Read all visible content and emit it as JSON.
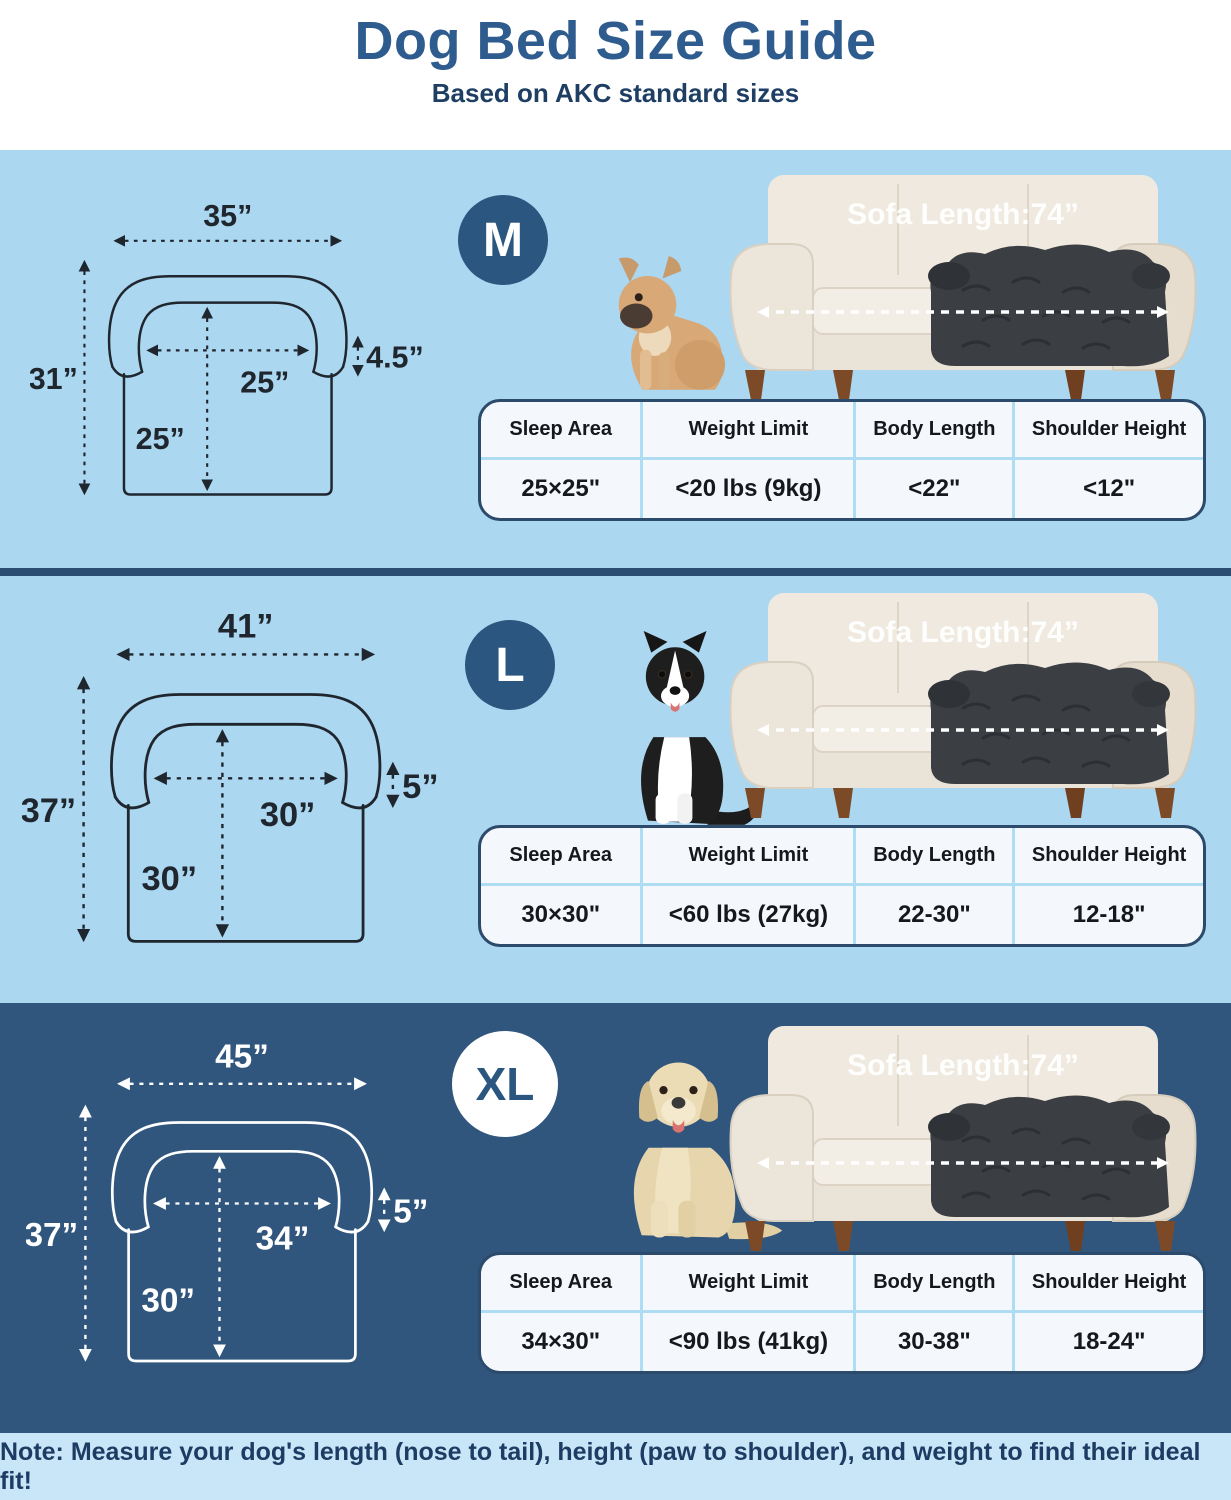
{
  "header": {
    "title": "Dog Bed Size Guide",
    "subtitle": "Based on AKC standard sizes"
  },
  "table_headers": [
    "Sleep Area",
    "Weight Limit",
    "Body Length",
    "Shoulder Height"
  ],
  "sofa_label": "Sofa Length:74”",
  "sections": [
    {
      "size": "M",
      "dog": "french-bulldog",
      "dims": {
        "width": "35”",
        "height": "31”",
        "inner_width": "25”",
        "inner_depth": "25”",
        "bolster": "4.5”"
      },
      "table": [
        "25×25\"",
        "<20 lbs (9kg)",
        "<22\"",
        "<12\""
      ]
    },
    {
      "size": "L",
      "dog": "border-collie",
      "dims": {
        "width": "41”",
        "height": "37”",
        "inner_width": "30”",
        "inner_depth": "30”",
        "bolster": "5”"
      },
      "table": [
        "30×30\"",
        "<60 lbs (27kg)",
        "22-30\"",
        "12-18\""
      ]
    },
    {
      "size": "XL",
      "dog": "labrador-retriever",
      "dims": {
        "width": "45”",
        "height": "37”",
        "inner_width": "34”",
        "inner_depth": "30”",
        "bolster": "5”"
      },
      "table": [
        "34×30\"",
        "<90 lbs (41kg)",
        "30-38\"",
        "18-24\""
      ]
    }
  ],
  "note": {
    "text": "Note: Measure your dog's length (nose to tail), height (paw to shoulder), and weight to find their ideal fit!"
  },
  "colors": {
    "title_blue": "#2e5c8e",
    "subtitle_navy": "#1e3f63",
    "section_light_blue": "#abd7f1",
    "section_dark_blue": "#31567d",
    "divider_navy": "#2c4d72",
    "badge_blue": "#2a567f",
    "table_bg": "#f4f8fc",
    "table_border": "#2c4a6b",
    "table_divider": "#aedcf2",
    "note_bg": "#c8e6f8",
    "diagram_line_dark": "#20262e",
    "diagram_line_light": "#ffffff",
    "sofa_cream": "#efe9e0",
    "dog_bed_charcoal": "#3b3e42"
  }
}
